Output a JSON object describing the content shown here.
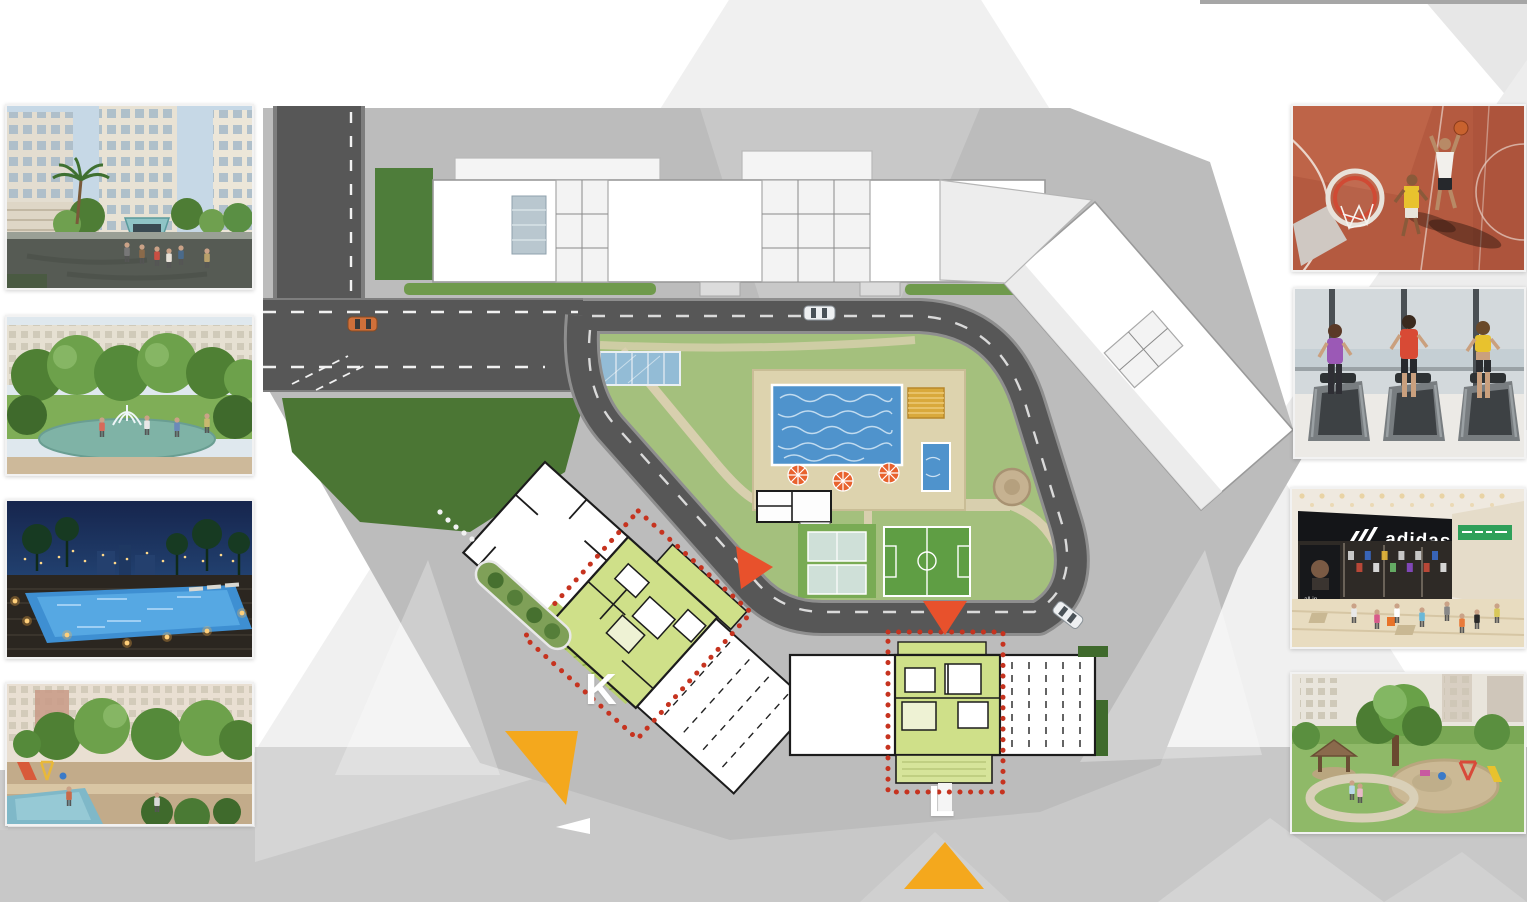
{
  "page": {
    "background": "#ffffff",
    "top_right_bar_color": "#a6a6a6"
  },
  "masterplan": {
    "labels": {
      "block_k": "K",
      "block_l": "L"
    },
    "colors": {
      "road": "#575757",
      "building_fill": "#ffffff",
      "building_wall": "#1c1c1c",
      "highlight_block": "#cfe089",
      "outline_dotted": "#c6331f",
      "entrance_arrow": "#e8512c",
      "marker_triangle": "#f4a81d",
      "pool_water": "#4f93cc",
      "lawn": "#a4c07d",
      "paving": "#bcbcbc",
      "deck_tan": "#ddd3ae"
    }
  },
  "photos": {
    "left": [
      {
        "id": "entrance-render"
      },
      {
        "id": "garden-fountain-render"
      },
      {
        "id": "night-pool-render"
      },
      {
        "id": "courtyard-playground-render"
      }
    ],
    "right": [
      {
        "id": "basketball-court-photo"
      },
      {
        "id": "gym-treadmills-photo"
      },
      {
        "id": "shopping-mall-photo",
        "sign_text": "adidas",
        "poster_lines": [
          "all in",
          "or",
          "nothing"
        ]
      },
      {
        "id": "park-playground-photo"
      }
    ]
  }
}
